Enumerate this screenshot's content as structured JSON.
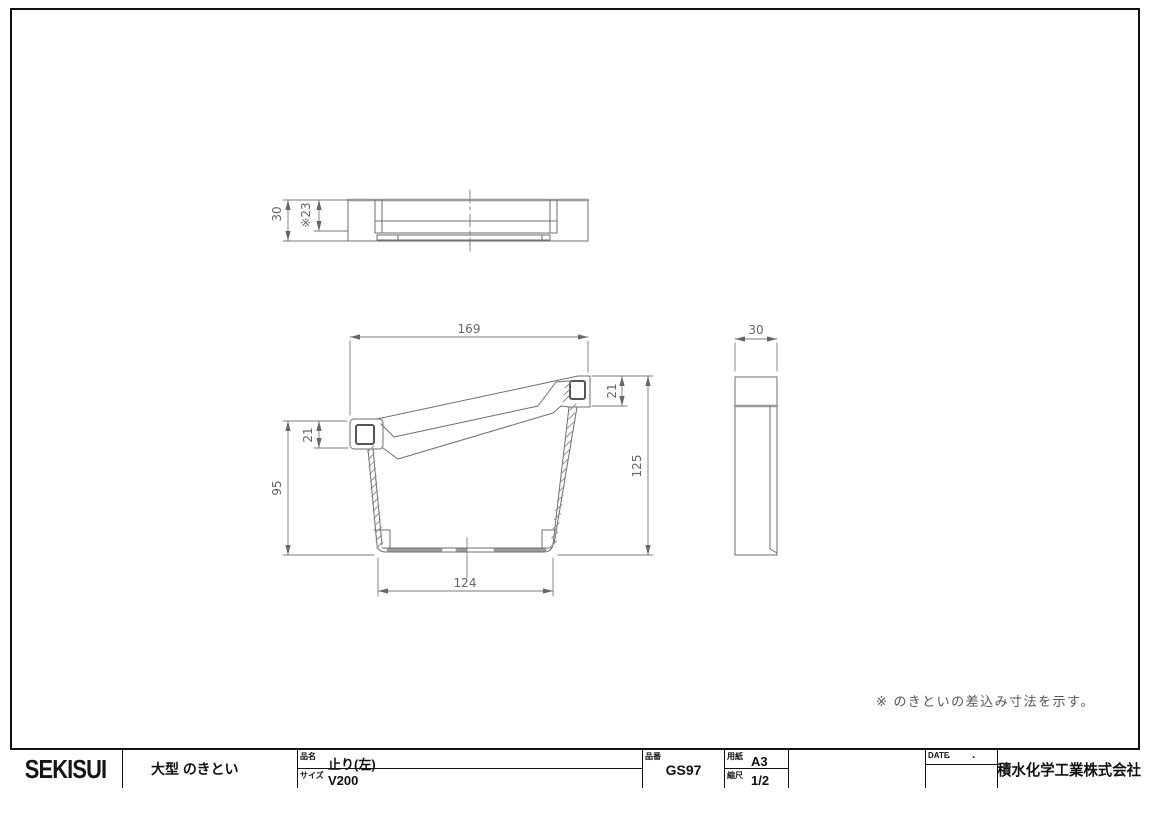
{
  "drawing": {
    "note": "※ のきといの差込み寸法を示す。",
    "dims": {
      "front_top_width": "169",
      "front_bottom_width": "124",
      "front_left_height": "95",
      "front_right_height": "125",
      "front_left_ear": "21",
      "front_right_ear": "21",
      "top_view_depth": "30",
      "top_view_insert": "※23",
      "side_view_width": "30"
    }
  },
  "title_block": {
    "logo": "SEKISUI",
    "product_category": "大型 のきとい",
    "name_label": "品名",
    "name_value": "止り(左)",
    "size_label": "サイズ",
    "size_value": "V200",
    "part_no_label": "品番",
    "part_no_value": "GS97",
    "paper_label": "用紙",
    "paper_value": "A3",
    "scale_label": "縮尺",
    "scale_value": "1/2",
    "date_label": "DATE",
    "date_value": "· ·",
    "company": "積水化学工業株式会社"
  }
}
